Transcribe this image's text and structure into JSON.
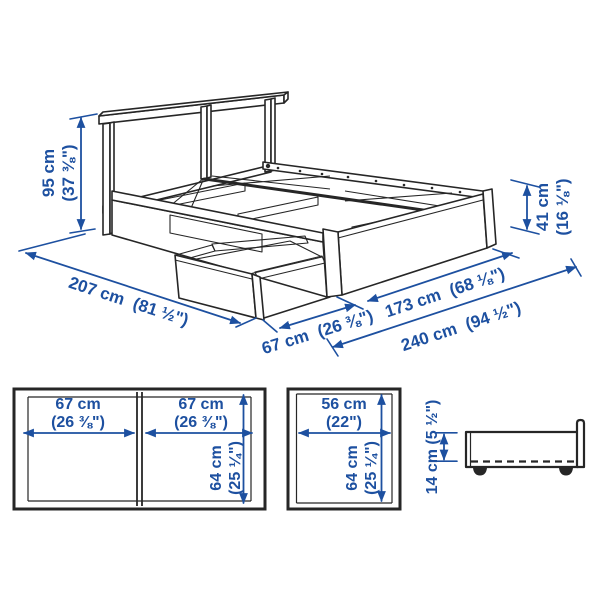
{
  "colors": {
    "dimension_blue": "#1D50A0",
    "outline_dark": "#262626",
    "background": "#FFFFFF"
  },
  "perspective_view": {
    "headboard_height": {
      "metric": "95 cm",
      "imperial": "(37 ⅜\")"
    },
    "bed_length": {
      "metric": "207 cm",
      "imperial": "(81 ½\")"
    },
    "storage_box_pullout": {
      "metric": "67 cm",
      "imperial": "(26 ⅜\")"
    },
    "bed_width": {
      "metric": "173 cm",
      "imperial": "(68 ⅛\")"
    },
    "total_width_box_open": {
      "metric": "240 cm",
      "imperial": "(94 ½\")"
    },
    "footboard_height": {
      "metric": "41 cm",
      "imperial": "(16 ⅛\")"
    }
  },
  "front_view_two_boxes": {
    "left_width": {
      "metric": "67 cm",
      "imperial": "(26 ⅜\")"
    },
    "right_width": {
      "metric": "67 cm",
      "imperial": "(26 ⅜\")"
    },
    "height": {
      "metric": "64 cm",
      "imperial": "(25 ¼\")"
    }
  },
  "front_view_single_box": {
    "width": {
      "metric": "56 cm",
      "imperial": "(22\")"
    },
    "height": {
      "metric": "64 cm",
      "imperial": "(25 ¼\")"
    }
  },
  "side_view_box": {
    "height": {
      "metric": "14 cm (5 ½\")"
    }
  }
}
